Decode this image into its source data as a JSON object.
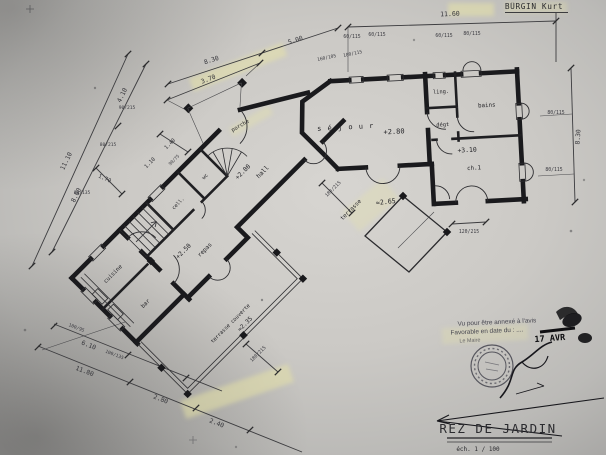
{
  "drawing": {
    "architect": "BÜRGIN Kurt",
    "title": "REZ  DE  JARDIN",
    "scale": "éch.  1 / 100"
  },
  "rooms": {
    "sejour": "s é j o u r",
    "ling": "ling.",
    "bains": "bains",
    "degt": "dégt",
    "ch1": "ch.1",
    "hall": "hall",
    "wc": "wc",
    "cell": "cell.",
    "cuisine": "cuisine",
    "repas": "repas",
    "bar": "bar",
    "terrasse_couverte": "terrasse couverte",
    "terrasse": "terrasse",
    "porche": "porche"
  },
  "levels": {
    "sejour": "+2.80",
    "ch1": "+3.10",
    "hall": "+2.80",
    "repas": "+2.50",
    "terrasse": "≈2.65",
    "terrasse_couverte": "≈2.35"
  },
  "dims": {
    "overall_top": "11.60",
    "slant_a": "8.30",
    "slant_b": "5.00",
    "porch_width": "3.70",
    "right_height": "8.30",
    "left_outer": "11.10",
    "left_inner": "8.00",
    "left_top": "4.10",
    "stair_width": "1.70",
    "entry_a": "1.40",
    "entry_b": "1.10",
    "bottom_total": "11.80",
    "bottom_b": "2.80",
    "bottom_c": "2.40",
    "bottom_inner": "6.10"
  },
  "openings": {
    "top_1": "60/115",
    "top_2": "60/115",
    "top_3": "60/115",
    "top_4": "80/115",
    "slant_1": "160/105",
    "slant_2": "180/115",
    "right_1": "80/115",
    "right_2": "80/115",
    "ch1_door": "120/215",
    "terrace_door": "180/215",
    "tc_door": "180/215",
    "left_1": "90/215",
    "left_2": "80/215",
    "left_3": "80/135",
    "entry_win": "90/75",
    "bottom_1": "100/95",
    "bottom_2": "100/135"
  },
  "stamp": {
    "line1": "Vu pour être annexé à l'avis",
    "line2": "Favorable en date du : ....",
    "date": "17 AVR",
    "signed_by": "Le Maire"
  }
}
